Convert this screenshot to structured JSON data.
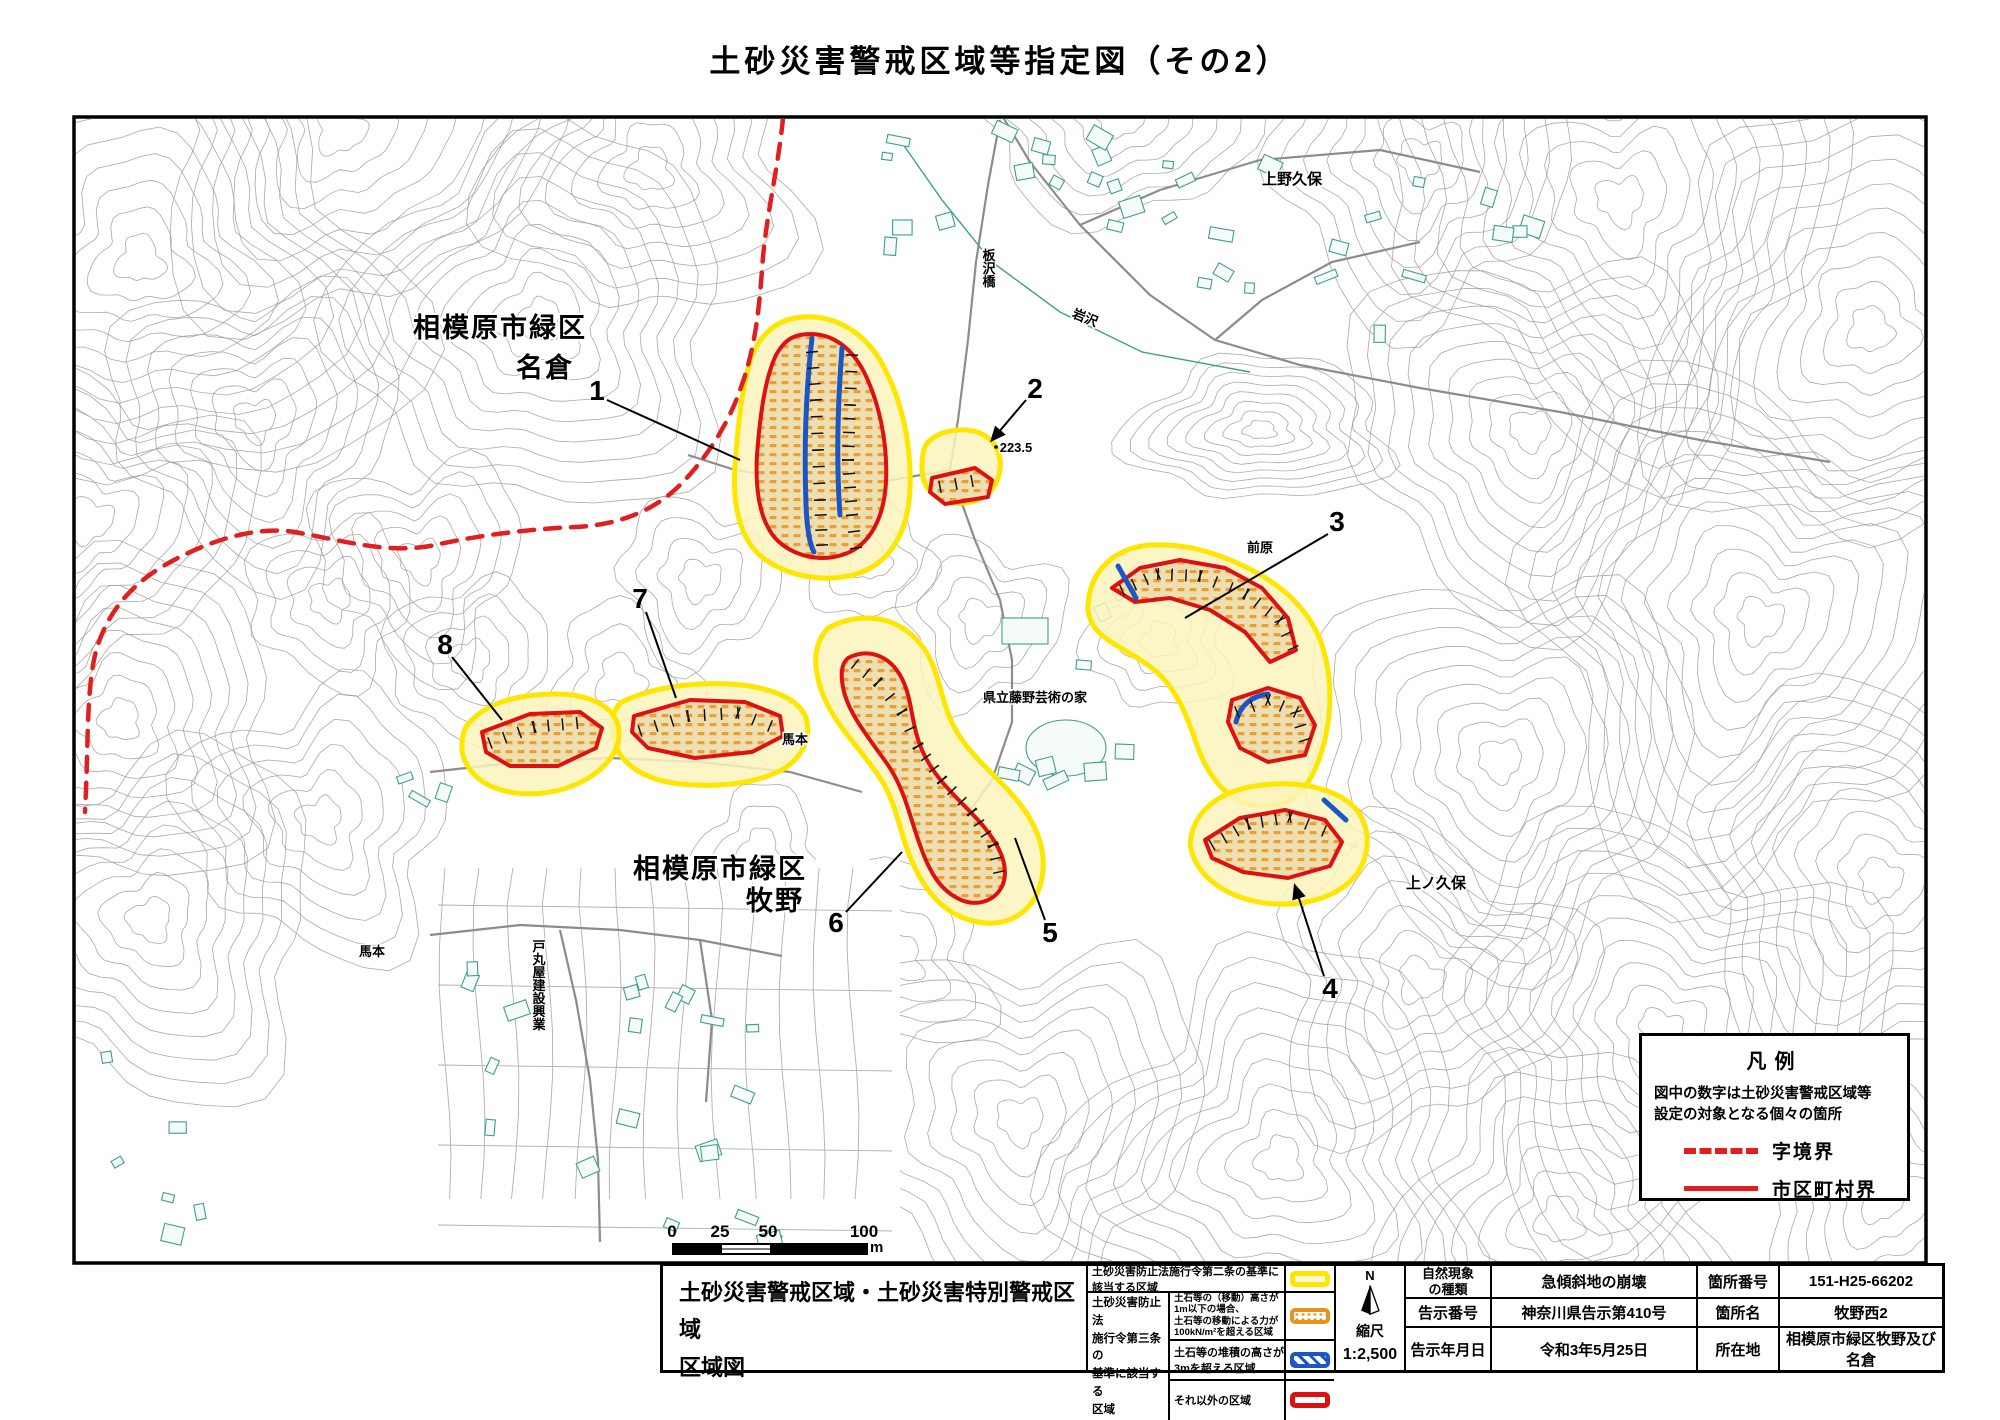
{
  "title": "土砂災害警戒区域等指定図（その2）",
  "map": {
    "district1_line1": "相模原市緑区",
    "district1_line2": "名倉",
    "district2_line1": "相模原市緑区",
    "district2_line2": "牧野",
    "labels": {
      "uenokubo": "上野久保",
      "kaminokubo": "上ノ久保",
      "maehara": "前原",
      "iwasawa": "岩沢",
      "itazawabashi": "板沢橋",
      "geijutsunoie": "県立藤野芸術の家",
      "umamoto_a": "馬本",
      "umamoto_b": "馬本",
      "tomaru": "戸丸屋建設興業",
      "elevation": "223.5"
    },
    "zone_numbers": [
      "1",
      "2",
      "3",
      "4",
      "5",
      "6",
      "7",
      "8"
    ]
  },
  "legend_box": {
    "title": "凡例",
    "note_line1": "図中の数字は土砂災害警戒区域等",
    "note_line2": "設定の対象となる個々の箇所",
    "dashed_label": "字境界",
    "solid_label": "市区町村界"
  },
  "scale_bar": {
    "tick0": "0",
    "tick25": "25",
    "tick50": "50",
    "tick100": "100",
    "unit": "m"
  },
  "footer_table": {
    "map_title_line1": "土砂災害警戒区域・土砂災害特別警戒区域",
    "map_title_line2": "区域図",
    "law2_label": "土砂災害防止法施行令第二条の基準に該当する区域",
    "law3_line1": "土砂災害防止法",
    "law3_line2": "施行令第三条の",
    "law3_line3": "基準に該当する",
    "law3_line4": "区域",
    "row_orange_line1": "土石等の（移動）高さが1m以下の場合、",
    "row_orange_line2": "土石等の移動による力が100kN/m²を超える区域",
    "row_blue": "土石等の堆積の高さが3mを超える区域",
    "row_red": "それ以外の区域",
    "north": "N",
    "scale_label": "縮尺",
    "scale_value": "1:2,500",
    "info": {
      "r1c1_l1": "自然現象",
      "r1c1_l2": "の種類",
      "r1c2": "急傾斜地の崩壊",
      "r1c3": "箇所番号",
      "r1c4": "151-H25-66202",
      "r2c1": "告示番号",
      "r2c2": "神奈川県告示第410号",
      "r2c3": "箇所名",
      "r2c4": "牧野西2",
      "r3c1": "告示年月日",
      "r3c2": "令和3年5月25日",
      "r3c3": "所在地",
      "r3c4": "相模原市緑区牧野及び名倉"
    }
  },
  "colors": {
    "zone_yellow": "#ffe600",
    "zone_yellow_fill": "#fbf3bb",
    "zone_red": "#dd1111",
    "zone_tan": "#eedfb2",
    "zone_orange": "#e8941c",
    "zone_blue": "#1a56c4",
    "boundary_red": "#e02020",
    "contour_gray": "#a09a93",
    "building_teal": "#3f9e8f",
    "road_gray": "#8c8c8c"
  }
}
